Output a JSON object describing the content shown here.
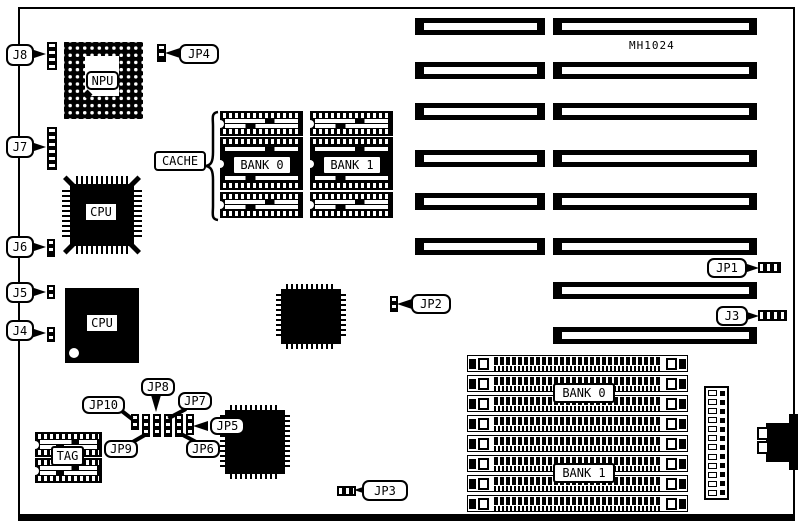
{
  "board": {
    "model": "MH1024",
    "silkscreen_color": "#000000",
    "background_color": "#ffffff"
  },
  "chips": {
    "npu_label": "NPU",
    "cpu_label": "CPU",
    "cpu2_label": "CPU",
    "cache_label": "CACHE",
    "cache_bank0_label": "BANK 0",
    "cache_bank1_label": "BANK 1",
    "tag_label": "TAG",
    "simm_bank0_label": "BANK 0",
    "simm_bank1_label": "BANK 1"
  },
  "jumper_labels": {
    "j3": "J3",
    "j4": "J4",
    "j5": "J5",
    "j6": "J6",
    "j7": "J7",
    "j8": "J8",
    "jp1": "JP1",
    "jp2": "JP2",
    "jp3": "JP3",
    "jp4": "JP4",
    "jp5": "JP5",
    "jp6": "JP6",
    "jp7": "JP7",
    "jp8": "JP8",
    "jp9": "JP9",
    "jp10": "JP10"
  },
  "counts": {
    "isa_slots_left_column": 6,
    "isa_slots_right_column": 8,
    "simm_sockets": 8,
    "cache_chips_per_bank": 3,
    "tag_chips": 2,
    "power_connector_pins": 12
  }
}
